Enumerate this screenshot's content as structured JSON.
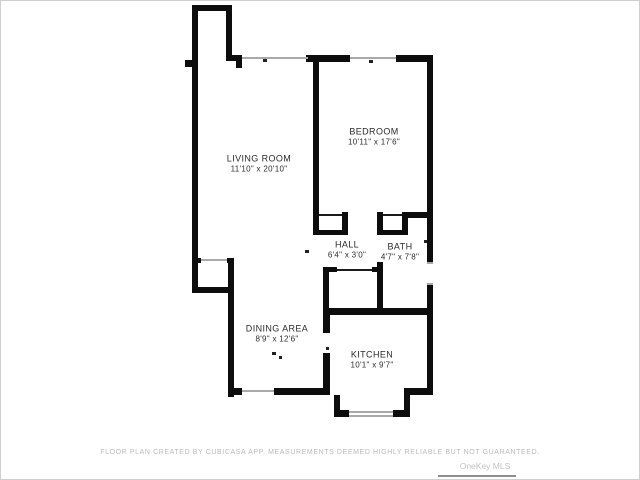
{
  "page": {
    "background": "#ffffff",
    "frame_color": "#cfcfcf",
    "wall_color": "#0d0d0d",
    "window_color": "#a9a9a9"
  },
  "floor_plan": {
    "rooms": [
      {
        "name": "LIVING ROOM",
        "dimensions": "11'10\" x 20'10\""
      },
      {
        "name": "BEDROOM",
        "dimensions": "10'11\" x 17'6\""
      },
      {
        "name": "HALL",
        "dimensions": "6'4\" x 3'0\""
      },
      {
        "name": "BATH",
        "dimensions": "4'7\" x 7'8\""
      },
      {
        "name": "DINING AREA",
        "dimensions": "8'9\" x 12'6\""
      },
      {
        "name": "KITCHEN",
        "dimensions": "10'1\" x 9'7\""
      }
    ]
  },
  "footer": {
    "disclaimer": "FLOOR PLAN CREATED BY CUBICASA APP. MEASUREMENTS DEEMED HIGHLY RELIABLE BUT NOT GUARANTEED.",
    "watermark": "OneKey MLS"
  }
}
